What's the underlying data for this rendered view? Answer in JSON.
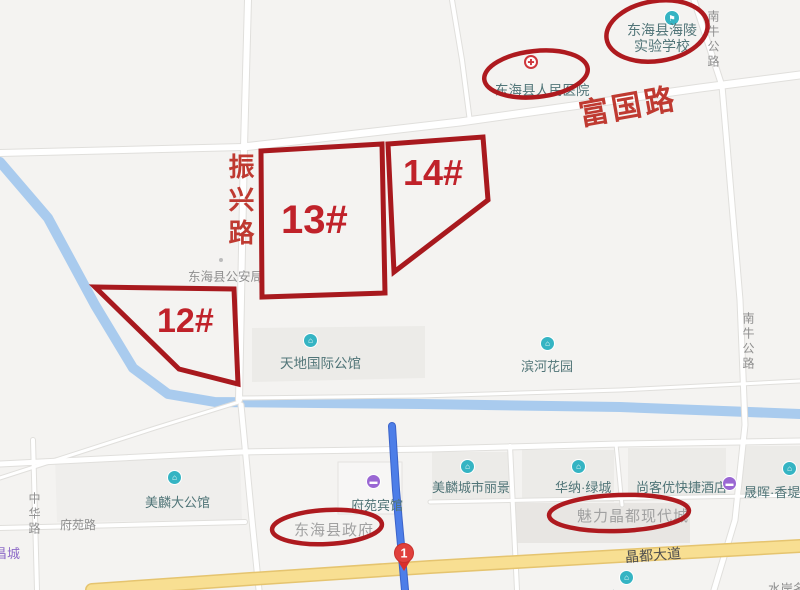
{
  "colors": {
    "annotation_red": "#ae1a1f",
    "parcel_stroke_red": "#a8191e",
    "number_red": "#c0222a",
    "road_name_red": "#bf3a31",
    "poi_teal": "#35b4c3",
    "poi_purple": "#9a67d3",
    "hospital_red": "#cf363c",
    "river_blue": "#a9cbee",
    "route_blue": "#4d7ee8",
    "road_yellow": "#f8df92",
    "poi_label_teal_grey": "#517578",
    "minor_label_grey": "#8f8f8f"
  },
  "annotations": {
    "parcels": [
      {
        "label": "12#"
      },
      {
        "label": "13#"
      },
      {
        "label": "14#"
      }
    ],
    "road_names": {
      "fuguo": "富国路",
      "zhenxing": "振兴路"
    },
    "circled": {
      "government": "东海县政府",
      "meili_modern_city": "魅力晶都现代城"
    },
    "marker_number": "1"
  },
  "pois": {
    "school": {
      "line1": "东海县海陵",
      "line2": "实验学校"
    },
    "hospital": "东海县人民医院",
    "police": "东海县公安局",
    "tiandi_mansion": "天地国际公馆",
    "binhe_garden": "滨河花园",
    "meilin_mansion": "美麟大公馆",
    "fuyuan_hotel": "府苑宾馆",
    "meilin_city_view": "美麟城市丽景",
    "huana_green_city": "华纳·绿城",
    "shangkeyou_hotel": "尚客优快捷酒店",
    "shenghui_xiangti": "晟晖·香堤",
    "xincheng": "新城",
    "shuian": "水岸名",
    "changcheng": "昌城"
  },
  "roads": {
    "nanniu_top": "南牛公路",
    "nanniu_right": "南牛公路",
    "zhonghua": "中华路",
    "fuyuan_road": "府苑路",
    "jingdu_avenue": "晶都大道"
  }
}
